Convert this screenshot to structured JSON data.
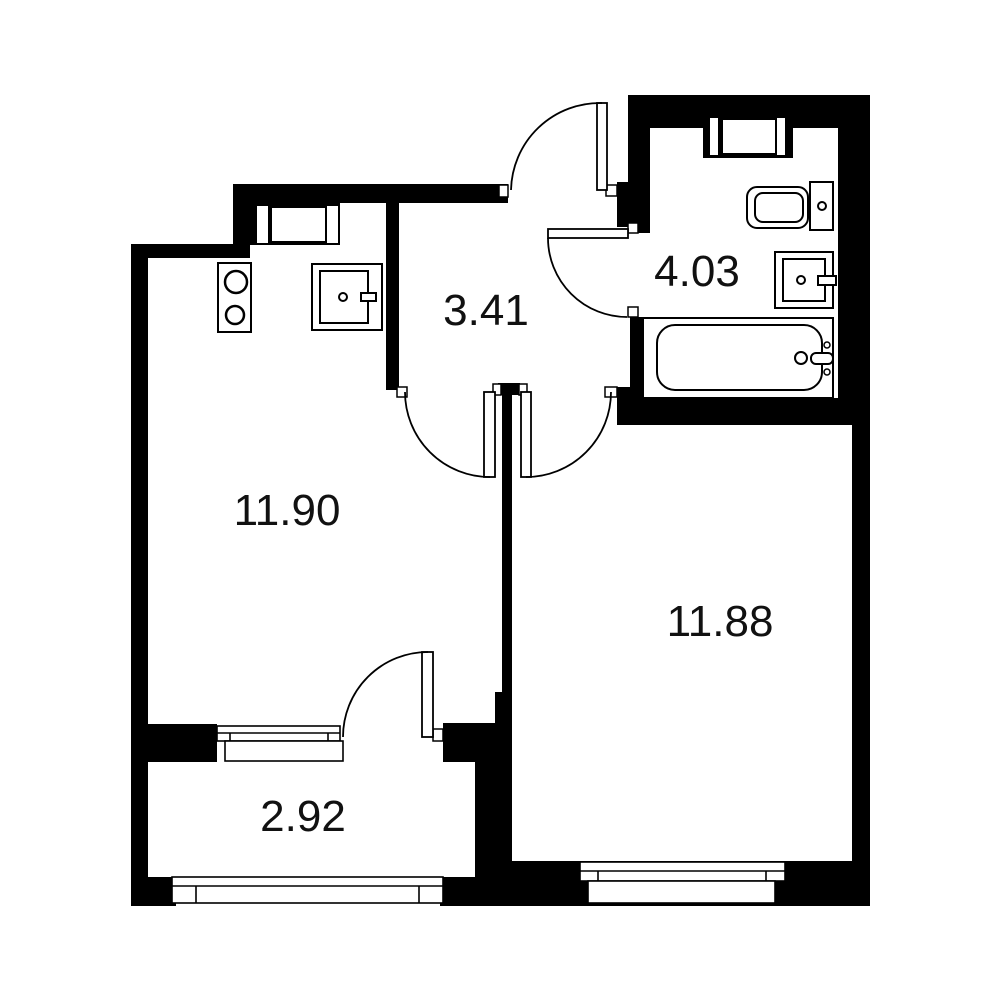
{
  "plan": {
    "type": "apartment-floor-plan",
    "background_color": "#ffffff",
    "wall_color": "#000000",
    "label_color": "#111111",
    "rooms": {
      "kitchen": {
        "area": "11.90"
      },
      "hallway": {
        "area": "3.41"
      },
      "bathroom": {
        "area": "4.03"
      },
      "living_room": {
        "area": "11.88"
      },
      "balcony": {
        "area": "2.92"
      }
    },
    "fixtures": {
      "kitchen": [
        "stove-icon",
        "kitchen-sink-icon"
      ],
      "bathroom": [
        "toilet-icon",
        "washbasin-icon",
        "bathtub-icon"
      ],
      "openings": [
        "entrance-door",
        "bathroom-door",
        "kitchen-door",
        "room-door",
        "balcony-door"
      ],
      "windows": [
        "kitchen-window",
        "bathroom-window",
        "balcony-window",
        "room-window",
        "balcony-glazing"
      ]
    }
  }
}
